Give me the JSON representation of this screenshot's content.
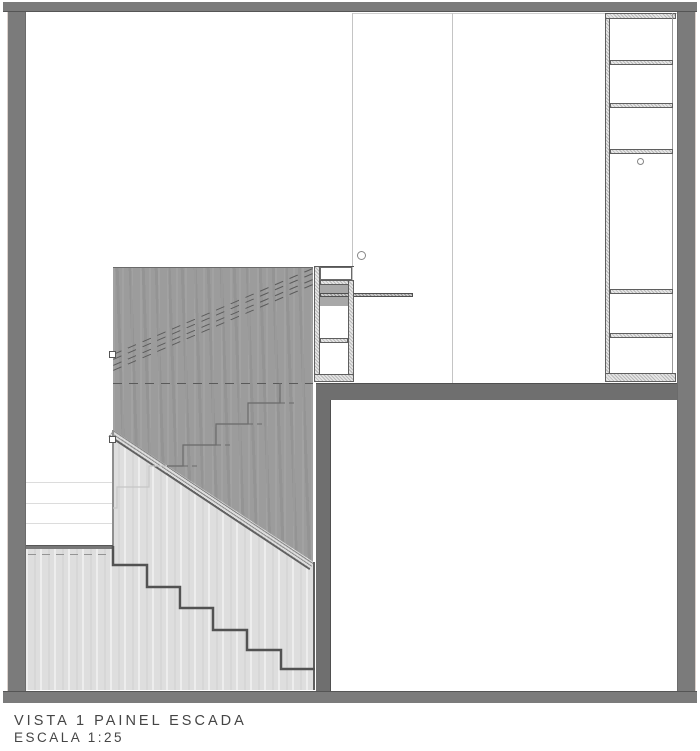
{
  "document": {
    "title": "VISTA 1 PAINEL ESCADA",
    "scale": "ESCALA 1:25"
  },
  "palette": {
    "background": "#ffffff",
    "wall_gray": "#7b7b7b",
    "slab_gray": "#6f6f6f",
    "stair_panel_dark_gray": "#9c9c9c",
    "stair_panel_light_gray": "#dedede",
    "outline_dark": "#545454",
    "text_gray": "#454545"
  }
}
